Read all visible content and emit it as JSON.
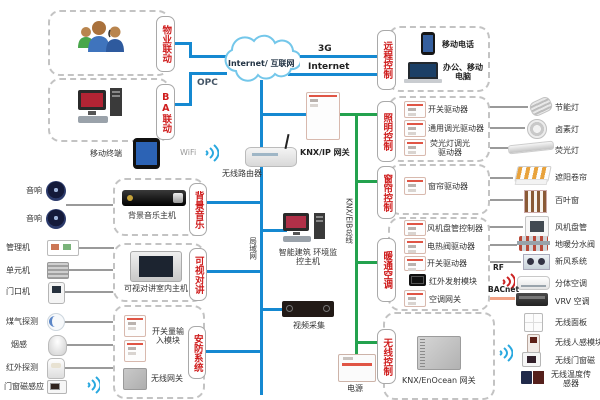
{
  "network": {
    "cloud": "Internet/ 互联网",
    "opc": "OPC",
    "g3": "3G",
    "internet": "Internet",
    "wifi": "WiFi",
    "mobile_terminal": "移动终端",
    "router": "无线路由器",
    "knx_ip_gateway": "KNX/IP 网关",
    "lan": "局域网",
    "knx_bus": "KNX/EIB总线",
    "monitor_host": "智能建筑 环境监控主机",
    "video": "视频采集",
    "power": "电源",
    "rf": "RF",
    "bacnet": "BACnet"
  },
  "boxes": {
    "property": {
      "tag": "物业联动"
    },
    "ba": {
      "tag": "BA联动"
    },
    "remote": {
      "tag": "远程控制",
      "phone": "移动电话",
      "computer": "办公、移动电脑"
    },
    "lighting": {
      "tag": "照明控制",
      "rows": [
        {
          "device": "开关驱动器",
          "target": "节能灯"
        },
        {
          "device": "通用调光驱动器",
          "target": "卤素灯"
        },
        {
          "device": "荧光灯调光驱动器",
          "target": "荧光灯"
        }
      ]
    },
    "curtain": {
      "tag": "窗帘控制",
      "device": "窗帘驱动器",
      "target1": "遮阳卷帘",
      "target2": "百叶窗"
    },
    "hvac": {
      "tag": "暖通空调",
      "rows": [
        {
          "device": "风机盘管控制器",
          "target": "风机盘管"
        },
        {
          "device": "电热阀驱动器",
          "target": "地暖分水阀"
        },
        {
          "device": "开关驱动器",
          "target": "新风系统"
        },
        {
          "device": "红外发射模块",
          "target": "分体空调"
        },
        {
          "device": "空调网关",
          "target": "VRV 空调"
        }
      ]
    },
    "wireless": {
      "tag": "无线控制",
      "gateway": "KNX/EnOcean 网关",
      "targets": [
        "无线面板",
        "无线人感模块",
        "无线门窗磁",
        "无线温度传感器"
      ]
    },
    "music": {
      "tag": "背景音乐",
      "host": "背景音乐主机",
      "speaker1": "音响",
      "speaker2": "音响"
    },
    "intercom": {
      "tag": "可视对讲",
      "host": "可视对讲室内主机",
      "src1": "管理机",
      "src2": "单元机",
      "src3": "门口机"
    },
    "security": {
      "tag": "安防系统",
      "module": "开关量输入模块",
      "gateway": "无线网关",
      "sensor1": "煤气探测",
      "sensor2": "烟感",
      "sensor3": "红外探测",
      "sensor4": "门窗磁感应"
    }
  }
}
